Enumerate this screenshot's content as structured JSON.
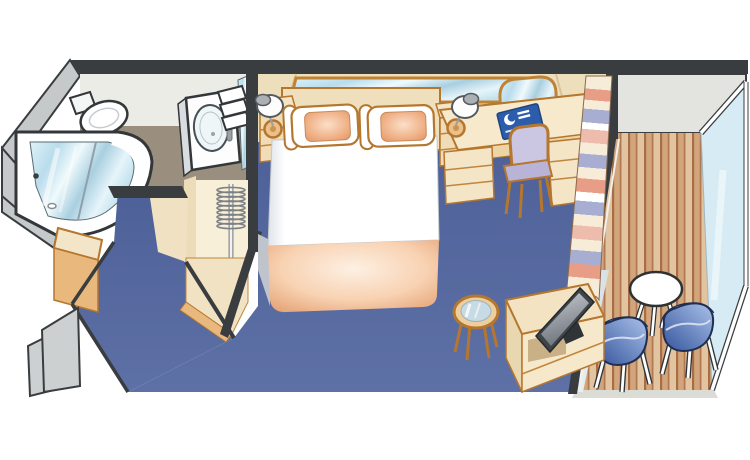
{
  "scene": {
    "kind": "isometric-cutaway-stateroom-floorplan",
    "background": "#ffffff",
    "rooms": [
      {
        "id": "bathroom",
        "items": [
          "toilet",
          "shower",
          "sink-vanity",
          "vanity-mirror",
          "towels"
        ]
      },
      {
        "id": "entry-hall",
        "items": [
          "entry-door-panels",
          "storage-bench",
          "bathroom-door-sill"
        ]
      },
      {
        "id": "wardrobe",
        "items": [
          "hanger-rod",
          "coat-hangers",
          "wardrobe-step"
        ]
      },
      {
        "id": "bedroom",
        "items": [
          "queen-bed",
          "pillow-left",
          "pillow-right",
          "peach-blanket",
          "headboard",
          "headboard-mirror",
          "nightstand-left",
          "nightstand-right",
          "wall-lamp-left",
          "wall-lamp-right",
          "vanity-desk",
          "desk-mirror",
          "desk-chair",
          "cruise-line-folder",
          "tv-cabinet",
          "flat-screen-tv",
          "glass-coffee-table"
        ]
      },
      {
        "id": "balcony",
        "items": [
          "sliding-door-curtain",
          "sliding-glass-door",
          "teak-deck",
          "round-deck-table",
          "deck-chair-left",
          "deck-chair-right",
          "glass-railing"
        ]
      }
    ]
  },
  "palette": {
    "background": "#ffffff",
    "wall_dark": "#3a3d40",
    "wall_exterior_gray": "#c6c9ca",
    "bathroom_wall": "#ececе7",
    "bathroom_floor_taupe": "#9a8f7f",
    "bedroom_wall_tan": "#eedfbc",
    "carpet_blue": "#54679c",
    "furniture_cream": "#f3e5c6",
    "furniture_outline_orange": "#b5762e",
    "drawer_front_orange": "#e9b87c",
    "door_panel_gray": "#ccd0d0",
    "deck_plank_brown": "#d2a57c",
    "deck_plank_light": "#e3c4a0",
    "deck_groove_brown": "#a86d45",
    "balcony_wall_gray": "#e3e4df",
    "railing_glass_blue": "#d6ebf3",
    "chair_blue": "#5f82c0",
    "pillow_peach": "#e8a379",
    "blanket_peach": "#f0b98f",
    "curtain_cream": "#f6ecd8",
    "curtain_salmon": "#e79d86",
    "curtain_lavender": "#a8aed2",
    "mirror_blue": "#cfe9f2",
    "logo_folder_blue": "#2c5cac",
    "desk_chair_lavender": "#cbc6e2",
    "tv_frame_gray": "#3f444a"
  }
}
